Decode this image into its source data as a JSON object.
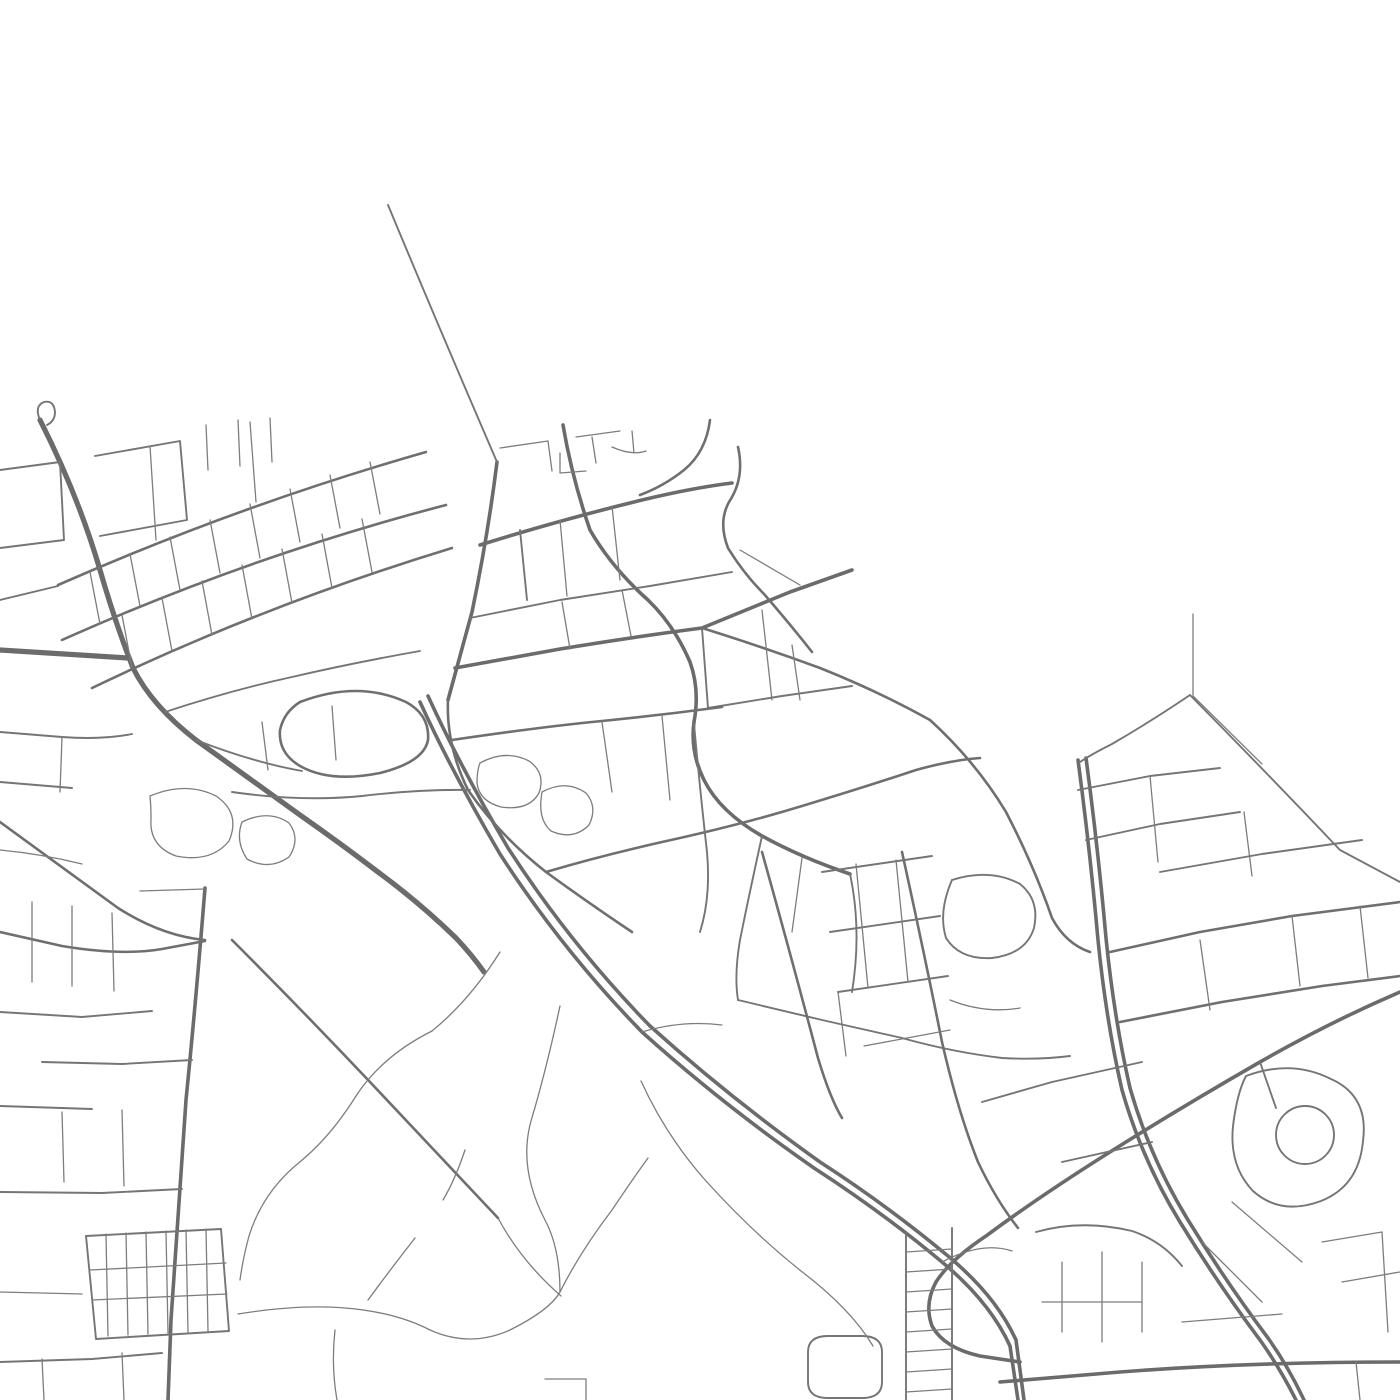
{
  "map": {
    "background": "#ffffff",
    "road_color_major": "#6b6b6b",
    "road_color_minor": "#757575",
    "road_color_path": "#7d7d7d",
    "stroke_classes": {
      "xl": {
        "width": 5.2,
        "color": "#6b6b6b"
      },
      "l": {
        "width": 3.6,
        "color": "#6b6b6b"
      },
      "m": {
        "width": 2.6,
        "color": "#6f6f6f"
      },
      "s": {
        "width": 1.9,
        "color": "#757575"
      },
      "xs": {
        "width": 1.3,
        "color": "#7d7d7d"
      }
    },
    "paths": [
      {
        "c": "xl",
        "d": "M40,420 Q78,495 100,570 Q115,622 133,668 Q152,706 196,740 L300,815 Q340,843 378,872 Q420,903 456,938 Q472,955 484,972"
      },
      {
        "c": "s",
        "d": "M40,420 Q34,406 44,402 Q54,400 55,412 Q55,421 47,425"
      },
      {
        "c": "l",
        "d": "M420,702 Q452,772 500,854 Q562,950 642,1032 Q722,1104 814,1168 Q882,1212 942,1262 Q990,1302 1010,1346 L1018,1400"
      },
      {
        "c": "l",
        "d": "M428,696 Q460,766 508,848 Q570,944 650,1026 Q730,1098 820,1162 Q888,1206 948,1256 Q996,1296 1016,1340 L1024,1400"
      },
      {
        "c": "xl",
        "d": "M0,650 L128,658"
      },
      {
        "c": "l",
        "d": "M1078,760 Q1090,850 1098,940 Q1106,1020 1122,1090 Q1142,1160 1180,1222 Q1218,1284 1260,1340 Q1280,1368 1296,1400"
      },
      {
        "c": "l",
        "d": "M1086,758 Q1098,848 1106,938 Q1114,1018 1130,1088 Q1150,1158 1188,1220 Q1226,1282 1268,1338 Q1288,1366 1304,1400"
      },
      {
        "c": "l",
        "d": "M455,668 L560,649 Q640,636 702,628 L790,592 L852,570"
      },
      {
        "c": "m",
        "d": "M702,628 Q760,646 820,668 Q880,692 930,720"
      },
      {
        "c": "m",
        "d": "M930,720 Q976,762 1006,812 Q1034,866 1052,918 Q1066,944 1090,952"
      },
      {
        "c": "l",
        "d": "M1400,992 Q1330,1022 1260,1062 Q1180,1108 1110,1152 Q1040,1196 986,1236 Q950,1260 936,1282 Q924,1304 932,1326 Q944,1348 980,1356 L1020,1362"
      },
      {
        "c": "l",
        "d": "M1000,1382 L1120,1372 Q1250,1362 1400,1362"
      },
      {
        "c": "l",
        "d": "M205,888 Q196,1000 186,1100 Q177,1230 171,1320 L168,1400"
      },
      {
        "c": "m",
        "d": "M232,940 Q300,1008 370,1082 Q440,1156 498,1218"
      },
      {
        "c": "m",
        "d": "M0,822 Q60,866 118,908 Q162,936 205,940"
      },
      {
        "c": "l",
        "d": "M497,462 Q488,535 472,612 Q458,664 448,700"
      },
      {
        "c": "m",
        "d": "M448,700 Q446,745 468,790 Q500,836 546,872 Q590,904 632,932"
      },
      {
        "c": "l",
        "d": "M563,425 Q572,478 590,530 Q612,568 648,600 Q674,625 690,662 Q700,690 694,722 Q690,752 704,780 Q720,812 762,836 Q802,858 850,874"
      },
      {
        "c": "l",
        "d": "M480,545 Q560,520 642,500 Q692,488 732,483"
      },
      {
        "c": "m",
        "d": "M710,420 Q706,452 684,470 Q664,486 640,495"
      },
      {
        "c": "m",
        "d": "M738,447 Q745,478 729,502 Q718,522 728,548 Q744,574 764,594 Q790,624 812,652"
      },
      {
        "c": "s",
        "d": "M388,205 Q440,330 497,462"
      },
      {
        "c": "s",
        "d": "M1190,695 Q1150,722 1112,744 Q1092,754 1080,762"
      },
      {
        "c": "xs",
        "d": "M1193,614 L1193,696 L1262,764"
      },
      {
        "c": "s",
        "d": "M1190,695 Q1266,772 1340,850 L1400,882"
      },
      {
        "c": "m",
        "d": "M58,585 Q240,505 426,452"
      },
      {
        "c": "m",
        "d": "M62,640 Q250,556 446,505"
      },
      {
        "c": "m",
        "d": "M92,688 Q262,606 452,548"
      },
      {
        "c": "xs",
        "d": "M90,572 L100,624"
      },
      {
        "c": "xs",
        "d": "M130,554 L140,606"
      },
      {
        "c": "xs",
        "d": "M170,537 L180,590"
      },
      {
        "c": "xs",
        "d": "M210,520 L220,573"
      },
      {
        "c": "xs",
        "d": "M250,504 L260,558"
      },
      {
        "c": "xs",
        "d": "M290,489 L300,542"
      },
      {
        "c": "xs",
        "d": "M330,475 L340,528"
      },
      {
        "c": "xs",
        "d": "M370,462 L380,514"
      },
      {
        "c": "xs",
        "d": "M122,615 L132,668"
      },
      {
        "c": "xs",
        "d": "M162,598 L172,651"
      },
      {
        "c": "xs",
        "d": "M202,581 L212,635"
      },
      {
        "c": "xs",
        "d": "M242,565 L252,619"
      },
      {
        "c": "xs",
        "d": "M282,549 L292,603"
      },
      {
        "c": "xs",
        "d": "M322,534 L332,588"
      },
      {
        "c": "xs",
        "d": "M362,519 L372,572"
      },
      {
        "c": "s",
        "d": "M0,470 L60,462 L64,540 L0,548"
      },
      {
        "c": "s",
        "d": "M95,456 L180,441 L187,520 L100,536"
      },
      {
        "c": "xs",
        "d": "M208,470 L206,425"
      },
      {
        "c": "xs",
        "d": "M240,466 L238,420"
      },
      {
        "c": "xs",
        "d": "M272,462 L270,418"
      },
      {
        "c": "s",
        "d": "M0,600 L58,586"
      },
      {
        "c": "xs",
        "d": "M150,446 L156,540"
      },
      {
        "c": "xs",
        "d": "M250,422 L256,502"
      },
      {
        "c": "m",
        "d": "M300,702 Q358,680 406,702 Q430,715 428,740 Q424,762 380,773 Q330,783 300,766 Q278,753 280,730 Q284,712 300,702"
      },
      {
        "c": "s",
        "d": "M165,712 Q232,690 292,677 Q352,663 420,651"
      },
      {
        "c": "s",
        "d": "M196,740 Q252,762 302,771"
      },
      {
        "c": "s",
        "d": "M232,792 Q302,802 362,796 Q422,789 470,790"
      },
      {
        "c": "xs",
        "d": "M262,722 L268,770"
      },
      {
        "c": "xs",
        "d": "M332,706 L336,760"
      },
      {
        "c": "xs",
        "d": "M150,796 Q186,781 216,796 Q241,813 229,841 Q211,863 176,856 Q149,846 151,819 Q151,806 150,796"
      },
      {
        "c": "xs",
        "d": "M242,822 Q269,809 289,823 Q301,839 289,857 Q269,871 247,859 Q235,841 242,822"
      },
      {
        "c": "s",
        "d": "M0,732 L62,737 Q102,740 132,734"
      },
      {
        "c": "xs",
        "d": "M62,737 L60,792"
      },
      {
        "c": "s",
        "d": "M0,782 L72,788"
      },
      {
        "c": "xs",
        "d": "M0,850 Q42,854 82,864"
      },
      {
        "c": "s",
        "d": "M520,530 L527,600"
      },
      {
        "c": "xs",
        "d": "M560,520 L567,596"
      },
      {
        "c": "xs",
        "d": "M612,506 L620,580"
      },
      {
        "c": "xs",
        "d": "M562,602 L570,649"
      },
      {
        "c": "xs",
        "d": "M622,590 L631,636"
      },
      {
        "c": "s",
        "d": "M702,628 L708,708"
      },
      {
        "c": "xs",
        "d": "M762,610 L772,700"
      },
      {
        "c": "xs",
        "d": "M740,550 L800,585"
      },
      {
        "c": "s",
        "d": "M708,708 L782,696 L852,686"
      },
      {
        "c": "xs",
        "d": "M792,645 L800,700"
      },
      {
        "c": "s",
        "d": "M470,618 L560,600 L650,586 L732,572"
      },
      {
        "c": "m",
        "d": "M452,740 Q540,727 602,721 Q662,715 722,707"
      },
      {
        "c": "m",
        "d": "M546,872 Q600,856 662,842 Q740,825 802,806 Q862,788 916,770 Q952,760 980,758"
      },
      {
        "c": "xs",
        "d": "M480,763 Q506,749 529,761 Q546,773 539,793 Q529,811 501,807 Q479,801 477,783 Q477,770 480,763"
      },
      {
        "c": "xs",
        "d": "M542,792 Q566,779 586,793 Q598,807 589,825 Q573,841 551,831 Q537,819 542,792"
      },
      {
        "c": "s",
        "d": "M762,836 Q748,900 740,940 Q734,975 738,1000"
      },
      {
        "c": "xs",
        "d": "M802,858 L792,932"
      },
      {
        "c": "s",
        "d": "M850,874 Q862,930 852,992"
      },
      {
        "c": "s",
        "d": "M738,1000 L822,1020 L902,1038"
      },
      {
        "c": "s",
        "d": "M902,1038 Q952,1052 1002,1058 Q1040,1060 1070,1056"
      },
      {
        "c": "xs",
        "d": "M602,722 L612,792"
      },
      {
        "c": "xs",
        "d": "M662,716 L670,800"
      },
      {
        "c": "s",
        "d": "M694,724 Q700,790 707,852 Q711,897 700,932"
      },
      {
        "c": "xs",
        "d": "M642,1032 Q682,1020 722,1025"
      },
      {
        "c": "xs",
        "d": "M942,1262 Q982,1241 1012,1251"
      },
      {
        "c": "m",
        "d": "M762,852 Q790,952 818,1058 Q830,1098 842,1118"
      },
      {
        "c": "m",
        "d": "M902,852 Q924,952 942,1042 Q958,1112 978,1162 Q996,1200 1018,1228"
      },
      {
        "c": "s",
        "d": "M822,872 L932,856"
      },
      {
        "c": "s",
        "d": "M830,932 L940,916"
      },
      {
        "c": "s",
        "d": "M838,992 L948,976"
      },
      {
        "c": "xs",
        "d": "M856,864 L868,988"
      },
      {
        "c": "xs",
        "d": "M896,860 L908,982"
      },
      {
        "c": "xs",
        "d": "M864,1046 L950,1030"
      },
      {
        "c": "xs",
        "d": "M838,992 L846,1056"
      },
      {
        "c": "s",
        "d": "M952,880 Q990,868 1020,884 Q1040,900 1034,928 Q1026,954 992,958 Q960,960 946,938 Q938,912 952,880"
      },
      {
        "c": "xs",
        "d": "M950,1000 Q985,1014 1020,1008"
      },
      {
        "c": "xs",
        "d": "M500,448 L548,441"
      },
      {
        "c": "xs",
        "d": "M548,441 L552,471"
      },
      {
        "c": "xs",
        "d": "M576,437 L620,431"
      },
      {
        "c": "xs",
        "d": "M592,437 L596,463"
      },
      {
        "c": "xs",
        "d": "M560,453 L560,473 L586,471"
      },
      {
        "c": "xs",
        "d": "M612,447 Q632,456 646,451"
      },
      {
        "c": "xs",
        "d": "M632,431 L634,453"
      },
      {
        "c": "s",
        "d": "M1078,790 L1150,776 L1220,768"
      },
      {
        "c": "s",
        "d": "M1086,840 L1160,824 L1240,812"
      },
      {
        "c": "xs",
        "d": "M1150,776 L1158,862"
      },
      {
        "c": "xs",
        "d": "M1244,812 L1252,876"
      },
      {
        "c": "m",
        "d": "M1110,952 L1200,932 L1292,916 L1400,902"
      },
      {
        "c": "m",
        "d": "M1120,1022 L1222,1002 L1322,986 L1400,976"
      },
      {
        "c": "s",
        "d": "M1160,872 L1262,854 L1362,840"
      },
      {
        "c": "s",
        "d": "M1246,1076 Q1291,1059 1331,1079 Q1369,1096 1363,1141 Q1359,1186 1321,1201 Q1281,1216 1253,1191 Q1229,1166 1233,1126 Q1237,1093 1246,1076"
      },
      {
        "c": "s",
        "d": "M1276,1135 A29,29 0 1 0 1334,1135 A29,29 0 1 0 1276,1135"
      },
      {
        "c": "s",
        "d": "M1052,1082 L1142,1062"
      },
      {
        "c": "s",
        "d": "M1062,1162 L1152,1142"
      },
      {
        "c": "s",
        "d": "M982,1102 L1052,1082"
      },
      {
        "c": "xs",
        "d": "M1200,940 L1210,1010"
      },
      {
        "c": "xs",
        "d": "M1292,916 L1300,986"
      },
      {
        "c": "xs",
        "d": "M1360,906 L1368,978"
      },
      {
        "c": "s",
        "d": "M1036,1232 Q1082,1219 1132,1231 Q1162,1241 1182,1266"
      },
      {
        "c": "xs",
        "d": "M1062,1262 L1062,1332"
      },
      {
        "c": "xs",
        "d": "M1102,1252 L1102,1342"
      },
      {
        "c": "xs",
        "d": "M1142,1262 L1142,1332"
      },
      {
        "c": "xs",
        "d": "M1042,1302 L1142,1302"
      },
      {
        "c": "xs",
        "d": "M1202,1242 L1262,1302"
      },
      {
        "c": "xs",
        "d": "M1232,1202 L1302,1262"
      },
      {
        "c": "xs",
        "d": "M1182,1322 L1282,1314"
      },
      {
        "c": "xs",
        "d": "M1322,1242 L1382,1232"
      },
      {
        "c": "xs",
        "d": "M1342,1282 L1400,1272"
      },
      {
        "c": "xs",
        "d": "M1382,1232 L1388,1332"
      },
      {
        "c": "xs",
        "d": "M1356,1362 L1360,1400"
      },
      {
        "c": "s",
        "d": "M1260,1062 L1276,1108"
      },
      {
        "c": "s",
        "d": "M906,1232 L906,1400"
      },
      {
        "c": "s",
        "d": "M952,1228 L952,1400"
      },
      {
        "c": "xs",
        "d": "M906,1252 L952,1249"
      },
      {
        "c": "xs",
        "d": "M906,1272 L952,1269"
      },
      {
        "c": "xs",
        "d": "M906,1292 L952,1289"
      },
      {
        "c": "xs",
        "d": "M906,1312 L952,1309"
      },
      {
        "c": "xs",
        "d": "M906,1332 L952,1329"
      },
      {
        "c": "xs",
        "d": "M906,1352 L952,1349"
      },
      {
        "c": "xs",
        "d": "M906,1372 L952,1369"
      },
      {
        "c": "xs",
        "d": "M906,1392 L952,1389"
      },
      {
        "c": "s",
        "d": "M808,1352 Q808,1336 828,1336 L862,1336 Q882,1336 882,1352 L882,1382 Q882,1398 862,1398 L828,1398 Q808,1398 808,1382 L808,1352"
      },
      {
        "c": "xs",
        "d": "M545,1379 L586,1379 L586,1400"
      },
      {
        "c": "xs",
        "d": "M500,952 Q470,1000 432,1031 Q382,1056 356,1096 Q331,1136 301,1161 Q263,1191 249,1236 Q243,1258 240,1280"
      },
      {
        "c": "xs",
        "d": "M560,1006 Q546,1071 531,1121 Q518,1168 545,1220 Q560,1248 560,1292"
      },
      {
        "c": "xs",
        "d": "M238,1314 Q300,1304 345,1308 Q395,1312 430,1330 Q470,1348 510,1330 Q550,1310 560,1292 Q580,1252 612,1210 Q632,1180 648,1158"
      },
      {
        "c": "xs",
        "d": "M465,1150 Q455,1180 443,1200"
      },
      {
        "c": "xs",
        "d": "M415,1238 Q390,1270 368,1300"
      },
      {
        "c": "xs",
        "d": "M641,1081 Q666,1136 706,1181 Q751,1231 801,1271 Q851,1309 873,1346"
      },
      {
        "c": "xs",
        "d": "M498,1218 Q521,1261 561,1296"
      },
      {
        "c": "xs",
        "d": "M335,1330 Q331,1366 337,1400"
      },
      {
        "c": "m",
        "d": "M0,932 L62,946 Q122,956 162,949 L205,941"
      },
      {
        "c": "xs",
        "d": "M32,902 L32,982"
      },
      {
        "c": "xs",
        "d": "M72,906 L72,986"
      },
      {
        "c": "xs",
        "d": "M112,913 L114,991"
      },
      {
        "c": "s",
        "d": "M0,1012 L82,1017 L152,1011"
      },
      {
        "c": "s",
        "d": "M42,1062 L122,1064 L192,1060"
      },
      {
        "c": "s",
        "d": "M0,1106 L92,1109"
      },
      {
        "c": "xs",
        "d": "M62,1112 L64,1182"
      },
      {
        "c": "xs",
        "d": "M122,1110 L124,1186"
      },
      {
        "c": "s",
        "d": "M0,1192 L102,1193 L182,1189"
      },
      {
        "c": "s",
        "d": "M86,1236 L221,1229 L229,1331 L96,1339 L86,1236"
      },
      {
        "c": "xs",
        "d": "M106,1234 L108,1336"
      },
      {
        "c": "xs",
        "d": "M126,1233 L128,1335"
      },
      {
        "c": "xs",
        "d": "M146,1232 L148,1334"
      },
      {
        "c": "xs",
        "d": "M166,1231 L168,1333"
      },
      {
        "c": "xs",
        "d": "M186,1230 L188,1332"
      },
      {
        "c": "xs",
        "d": "M206,1229 L208,1331"
      },
      {
        "c": "xs",
        "d": "M90,1270 L226,1263"
      },
      {
        "c": "xs",
        "d": "M92,1300 L227,1294"
      },
      {
        "c": "xs",
        "d": "M0,1292 L82,1294"
      },
      {
        "c": "s",
        "d": "M0,1362 L92,1359 L162,1353"
      },
      {
        "c": "xs",
        "d": "M42,1359 L44,1400"
      },
      {
        "c": "xs",
        "d": "M122,1353 L124,1400"
      },
      {
        "c": "xs",
        "d": "M140,891 L205,889"
      }
    ]
  }
}
